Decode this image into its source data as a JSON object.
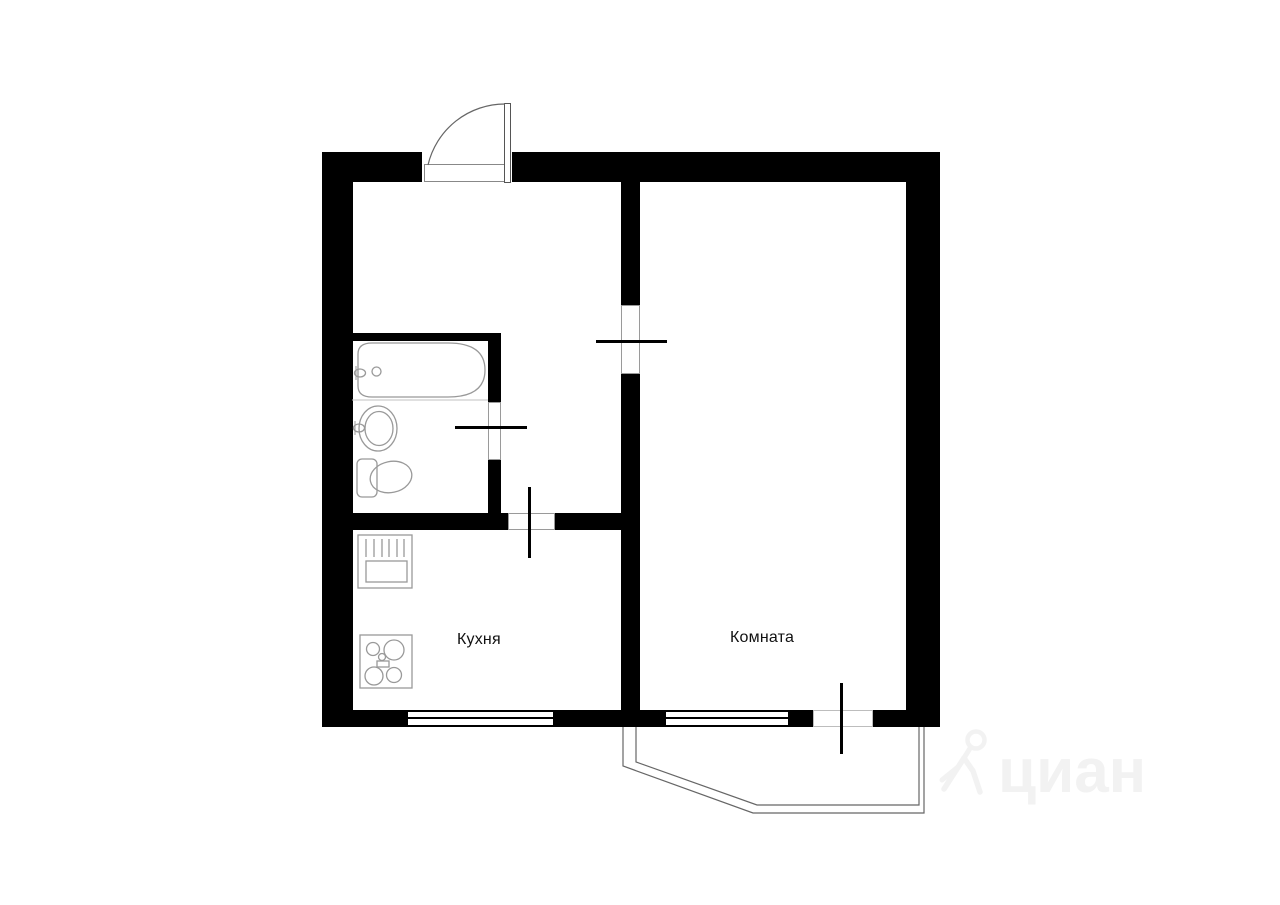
{
  "document": {
    "type": "apartment-floor-plan"
  },
  "rooms": {
    "kitchen_label": "Кухня",
    "room_label": "Комната"
  },
  "fixtures": [
    "bathtub-icon",
    "bathroom-sink-icon",
    "toilet-icon",
    "kitchen-sink-dryer-icon",
    "stove-icon"
  ],
  "openings": [
    "entrance-door",
    "room-door",
    "bathroom-door",
    "kitchen-door",
    "balcony-door",
    "kitchen-window",
    "room-window"
  ],
  "watermark": {
    "brand_text": "циан",
    "icon": "cian-pin-person-icon",
    "color": "#f2f2f2"
  },
  "colors": {
    "background": "#ffffff",
    "walls": "#000000",
    "fixture_stroke": "#999999",
    "thin_lines": "#666666",
    "label_text": "#111111"
  }
}
